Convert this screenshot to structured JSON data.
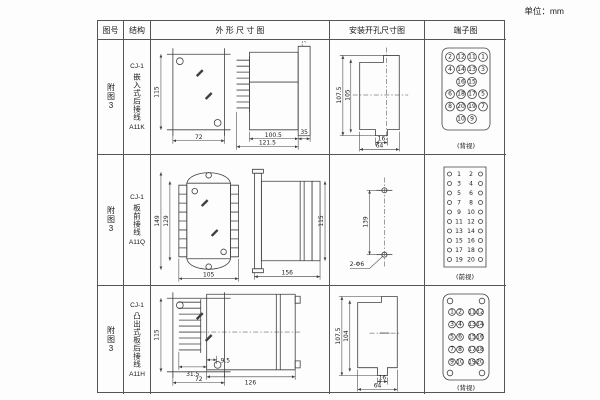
{
  "unit_label": "单位：mm",
  "colors": {
    "line": "#3f3f3f",
    "border": "#555555",
    "text": "#1a1a1a",
    "bg": "#fdfdfd"
  },
  "table": {
    "headers": {
      "fig": "图号",
      "structure": "结构",
      "outline": "外 形 尺 寸 图",
      "mounting": "安装开孔尺寸图",
      "terminal": "端子图"
    },
    "rows": [
      {
        "fig_no": "附图3",
        "structure_line1": "CJ-1",
        "structure_vertical": "嵌入式后接线",
        "structure_code": "A11K",
        "outline": {
          "front_h": "115",
          "front_w": "72",
          "side_body": "100.5",
          "side_total": "121.5",
          "side_flange": "35"
        },
        "mounting": {
          "outer_h": "107.5",
          "inner_h": "105",
          "inner_w": "16",
          "outer_w": "64"
        },
        "terminal": {
          "caption": "(背视)",
          "layout": "grid",
          "rows": [
            [
              "2",
              "12",
              "11",
              "1"
            ],
            [
              "4",
              "14",
              "13",
              "3"
            ],
            [
              "16",
              "15"
            ],
            [
              "6",
              "18",
              "17",
              "5"
            ],
            [
              "8",
              "20",
              "19",
              "7"
            ],
            [
              "10",
              "9"
            ]
          ]
        }
      },
      {
        "fig_no": "附图3",
        "structure_line1": "CJ-1",
        "structure_vertical": "板前接线",
        "structure_code": "A11Q",
        "outline": {
          "front_h_outer": "149",
          "front_h_inner": "129",
          "front_w": "105",
          "side_len": "156",
          "side_h": "115"
        },
        "mounting": {
          "hole_span": "139",
          "hole_label": "2-Φ6"
        },
        "terminal": {
          "caption": "(前视)",
          "layout": "columns",
          "pairs": [
            [
              "1",
              "2"
            ],
            [
              "3",
              "4"
            ],
            [
              "5",
              "6"
            ],
            [
              "7",
              "8"
            ],
            [
              "9",
              "10"
            ],
            [
              "11",
              "12"
            ],
            [
              "13",
              "14"
            ],
            [
              "15",
              "16"
            ],
            [
              "17",
              "18"
            ],
            [
              "19",
              "20"
            ]
          ]
        }
      },
      {
        "fig_no": "附图3",
        "structure_line1": "CJ-1",
        "structure_vertical": "凸出式板后接线",
        "structure_code": "A11H",
        "outline": {
          "front_h": "115",
          "front_w": "72",
          "pin_len": "31.5",
          "offset": "9.5",
          "side_len": "126"
        },
        "mounting": {
          "outer_h": "107.5",
          "inner_h": "104",
          "inner_w": "16",
          "outer_w": "64"
        },
        "terminal": {
          "caption": "(背视)",
          "layout": "pairs",
          "left": [
            [
              "1",
              "2"
            ],
            [
              "3",
              "4"
            ],
            [
              "5",
              "6"
            ],
            [
              "7",
              "8"
            ],
            [
              "9",
              "10"
            ]
          ],
          "right": [
            [
              "11",
              "12"
            ],
            [
              "13",
              "14"
            ],
            [
              "15",
              "16"
            ],
            [
              "17",
              "18"
            ],
            [
              "19",
              "20"
            ]
          ]
        }
      }
    ]
  }
}
